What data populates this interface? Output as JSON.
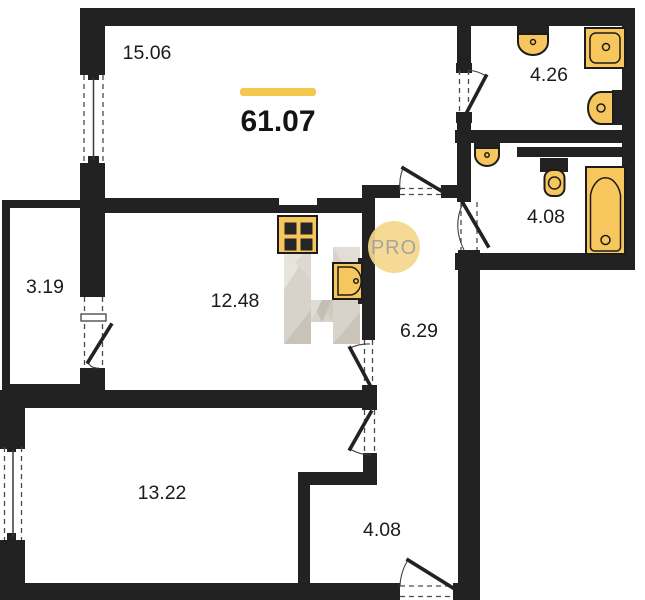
{
  "plan": {
    "total_area": "61.07",
    "rooms": {
      "living": "15.06",
      "bath_top": "4.26",
      "bath_right": "4.08",
      "balcony": "3.19",
      "kitchen": "12.48",
      "corridor": "6.29",
      "bedroom": "13.22",
      "hallway": "4.08"
    },
    "watermark": {
      "badge": "PRO",
      "monogram": "H"
    },
    "colors": {
      "wall": "#222222",
      "fixture_fill": "#F7C75D",
      "accent_line": "#F4C84F",
      "badge_bg": "#F3D78C",
      "badge_text": "#A6A49E",
      "monogram_tint": "#D7D2CA"
    },
    "icons": [
      "stove-icon",
      "kitchen-sink-icon",
      "wash-basin-icon",
      "washing-machine-icon",
      "toilet-icon",
      "bathtub-icon"
    ]
  }
}
